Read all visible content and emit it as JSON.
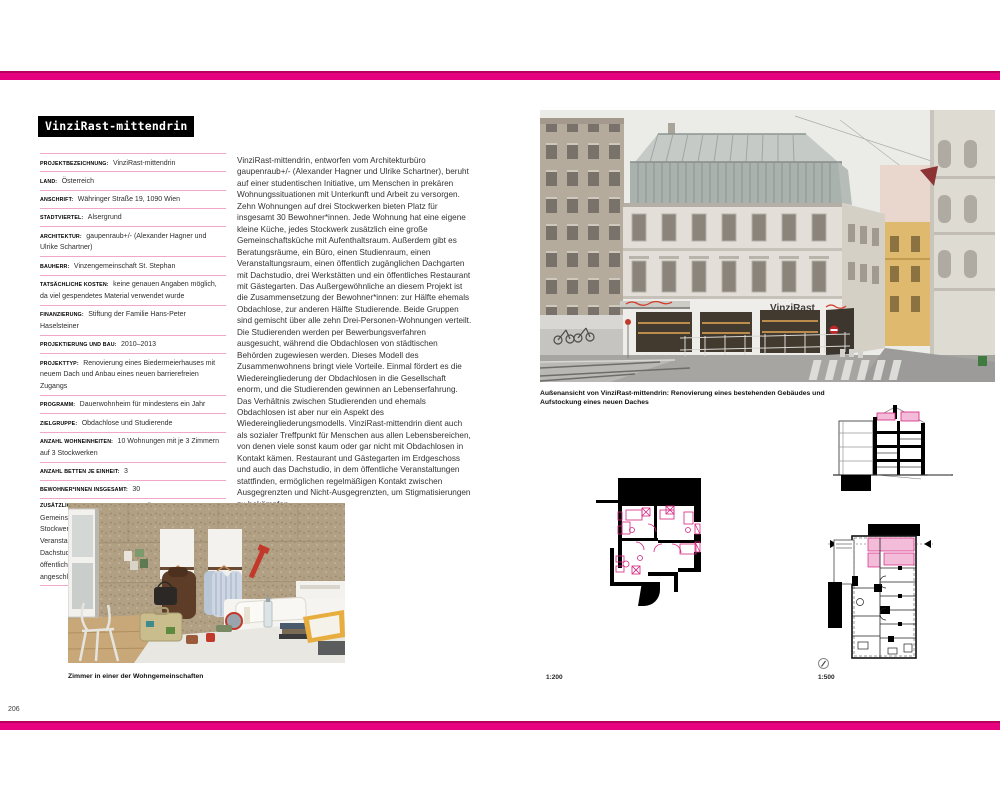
{
  "colors": {
    "accent_magenta": "#e6017e",
    "separator_pink": "#f1a7c9",
    "plan_pink": "#d6247f",
    "sign_red": "#d23c2a"
  },
  "page": {
    "number": "206"
  },
  "project": {
    "title": "VinziRast-mittendrin"
  },
  "meta_rows": [
    {
      "label": "PROJEKTBEZEICHNUNG:",
      "value": "VinziRast-mittendrin"
    },
    {
      "label": "LAND:",
      "value": "Österreich"
    },
    {
      "label": "ANSCHRIFT:",
      "value": "Währinger Straße 19, 1090 Wien"
    },
    {
      "label": "STADTVIERTEL:",
      "value": "Alsergrund"
    },
    {
      "label": "ARCHITEKTUR:",
      "value": "gaupenraub+/- (Alexander Hagner und Ulrike Schartner)"
    },
    {
      "label": "BAUHERR:",
      "value": "Vinzengemeinschaft St. Stephan"
    },
    {
      "label": "TATSÄCHLICHE KOSTEN:",
      "value": "keine genauen Angaben möglich, da viel gespendetes Material verwendet wurde"
    },
    {
      "label": "FINANZIERUNG:",
      "value": "Stiftung der Familie Hans-Peter Haselsteiner"
    },
    {
      "label": "PROJEKTIERUNG UND BAU:",
      "value": "2010–2013"
    },
    {
      "label": "PROJEKTTYP:",
      "value": "Renovierung eines Biedermeierhauses mit neuem Dach und Anbau eines neuen barrierefreien Zugangs"
    },
    {
      "label": "PROGRAMM:",
      "value": "Dauerwohnheim für mindestens ein Jahr"
    },
    {
      "label": "ZIELGRUPPE:",
      "value": "Obdachlose und Studierende"
    },
    {
      "label": "ANZAHL WOHNEINHEITEN:",
      "value": "10 Wohnungen mit je 3 Zimmern auf 3 Stockwerken"
    },
    {
      "label": "ANZAHL BETTEN JE EINHEIT:",
      "value": "3"
    },
    {
      "label": "BEWOHNER*INNEN INSGESAMT:",
      "value": "30"
    },
    {
      "label": "ZUSÄTZLICHE EINRICHTUNGEN IM GEBÄUDE:",
      "value": "Gemeinschaftsküche mit Aufenthaltsraum auf jedem Stockwerk, Beratungsräume, 1 Büro, 1 Studienraum, 1 Veranstaltungsraum, 1 Dachgarten mit angeschlossenem Dachstudio zur kostenlosen Nutzung, 3 Werkstätten, 1 öffentlicher Bereich mit Gästegarten und verschiedenen angeschlossenen Räumen"
    }
  ],
  "body_text": "VinziRast-mittendrin, entworfen vom Architekturbüro gaupenraub+/- (Alexander Hagner und Ulrike Schartner), beruht auf einer studentischen Initiative, um Menschen in prekären Wohnungssituationen mit Unterkunft und Arbeit zu versorgen. Zehn Wohnungen auf drei Stockwerken bieten Platz für insgesamt 30 Bewohner*innen. Jede Wohnung hat eine eigene kleine Küche, jedes Stockwerk zusätzlich eine große Gemeinschaftsküche mit Aufenthaltsraum. Außerdem gibt es Beratungsräume, ein Büro, einen Studienraum, einen Veranstaltungsraum, einen öffentlich zugänglichen Dachgarten mit Dachstudio, drei Werkstätten und ein öffentliches Restaurant mit Gästegarten. Das Außergewöhnliche an diesem Projekt ist die Zusammensetzung der Bewohner*innen: zur Hälfte ehemals Obdachlose, zur anderen Hälfte Studierende. Beide Gruppen sind gemischt über alle zehn Drei-Personen-Wohnungen verteilt. Die Studierenden werden per Bewerbungsverfahren ausgesucht, während die Obdachlosen von städtischen Behörden zugewiesen werden. Dieses Modell des Zusammenwohnens bringt viele Vorteile. Einmal fördert es die Wiedereingliederung der Obdachlosen in die Gesellschaft enorm, und die Studierenden gewinnen an Lebenserfahrung. Das Verhältnis zwischen Studierenden und ehemals Obdachlosen ist aber nur ein Aspekt des Wiedereingliederungsmodells. VinziRast-mittendrin dient auch als sozialer Treffpunkt für Menschen aus allen Lebensbereichen, von denen viele sonst kaum oder gar nicht mit Obdachlosen in Kontakt kämen. Restaurant und Gästegarten im Erdgeschoss und auch das Dachstudio, in dem öffentliche Veranstaltungen stattfinden, ermöglichen regelmäßigen Kontakt zwischen Ausgegrenzten und Nicht-Ausgegrenzten, um Stigmatisierungen zu bekämpfen.",
  "photos": {
    "building_caption": "Außenansicht von VinziRast-mittendrin: Renovierung eines bestehenden Gebäudes und Aufstockung eines neuen Daches",
    "building_sign": "VinziRast",
    "room_caption": "Zimmer in einer der Wohngemeinschaften"
  },
  "drawings": {
    "plan200_scale": "1:200",
    "plan500_scale": "1:500"
  }
}
